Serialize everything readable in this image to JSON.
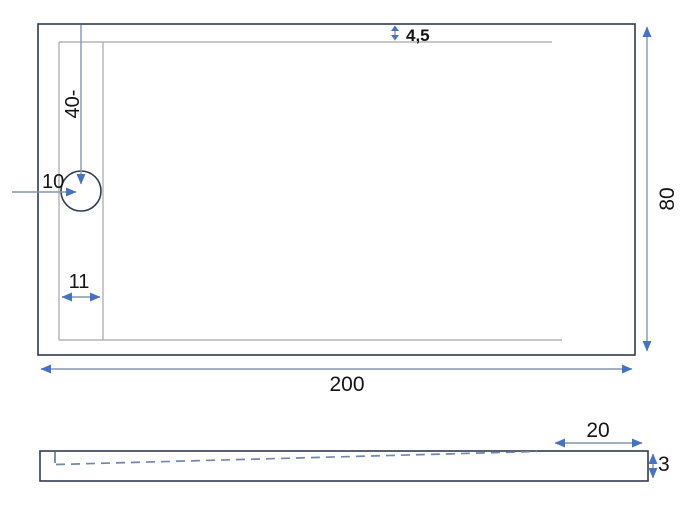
{
  "drawing": {
    "type": "technical-drawing",
    "views": [
      "plan",
      "section"
    ],
    "colors": {
      "outline": "#2f3b52",
      "inner_line": "#a6a6a6",
      "dimension_line": "#8496b0",
      "arrow": "#4472c4",
      "dash_line": "#7089ac",
      "label_text": "#141414",
      "background": "#ffffff"
    },
    "top_view": {
      "dims": {
        "rim": "4,5",
        "drain_from_top": "40-",
        "drain_from_left": "10",
        "left_channel": "11",
        "depth": "80",
        "width": "200"
      }
    },
    "side_view": {
      "dims": {
        "flat_end": "20",
        "thickness": "3"
      }
    }
  }
}
